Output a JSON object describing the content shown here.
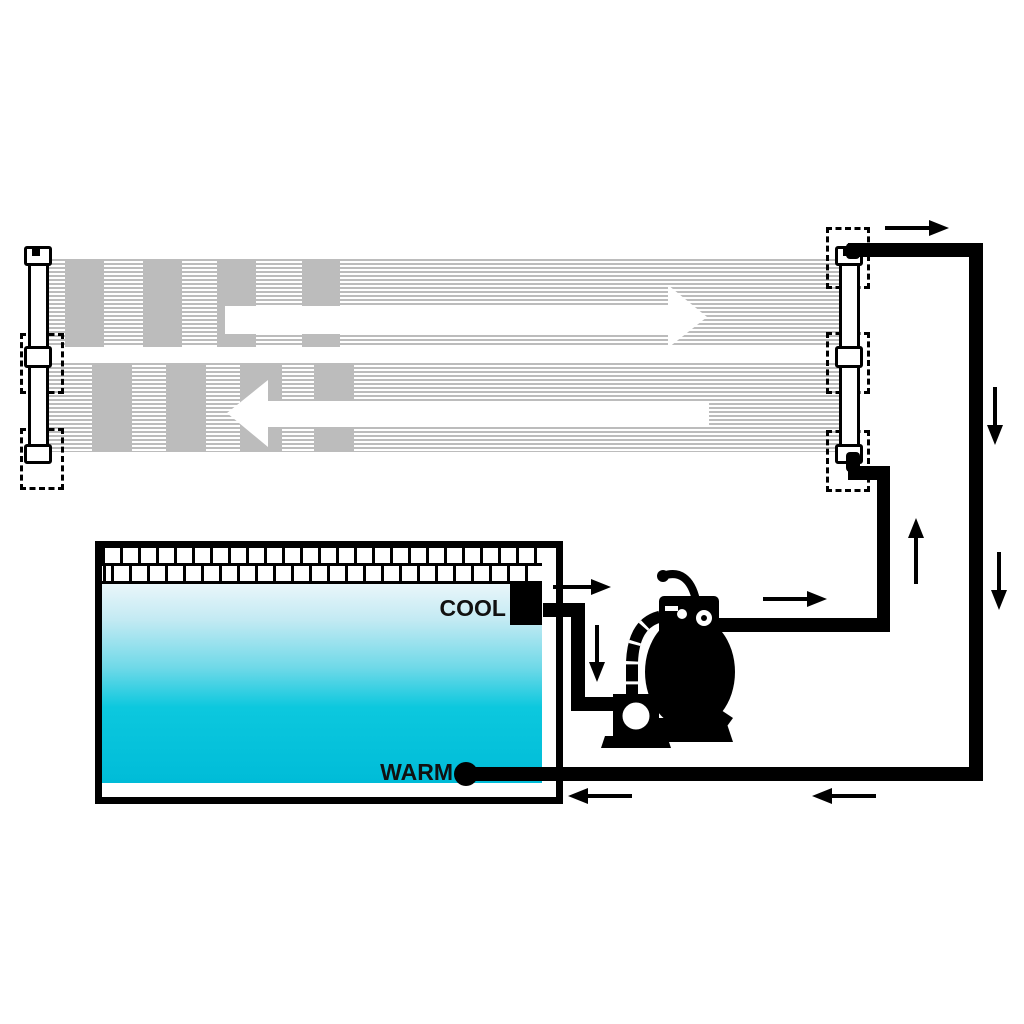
{
  "diagram": {
    "type": "solar-pool-heater-schematic",
    "labels": {
      "cool": "COOL",
      "warm": "WARM"
    },
    "colors": {
      "background": "#ffffff",
      "line_black": "#000000",
      "panel_gray": "#bcbcbc",
      "water_top": "#e9f6fa",
      "water_bottom": "#00bcd8"
    },
    "components": {
      "solar_collector": "dual striped heater mats with end manifolds and dashed connector positions",
      "pool": "tiled-edge pool with gradient water",
      "pump": "sand filter with multiport valve and pump"
    },
    "flow": {
      "panel_top_direction": "right",
      "panel_bottom_direction": "left",
      "arrows": [
        {
          "id": "collector-outlet-top",
          "direction": "right"
        },
        {
          "id": "return-riser-upper",
          "direction": "down"
        },
        {
          "id": "return-riser-lower",
          "direction": "down"
        },
        {
          "id": "supply-riser",
          "direction": "up"
        },
        {
          "id": "pool-outlet",
          "direction": "right"
        },
        {
          "id": "pool-outlet-drop",
          "direction": "down"
        },
        {
          "id": "pump-to-collector",
          "direction": "right"
        },
        {
          "id": "warm-return-inner",
          "direction": "left"
        },
        {
          "id": "warm-return-outer",
          "direction": "left"
        }
      ]
    }
  }
}
